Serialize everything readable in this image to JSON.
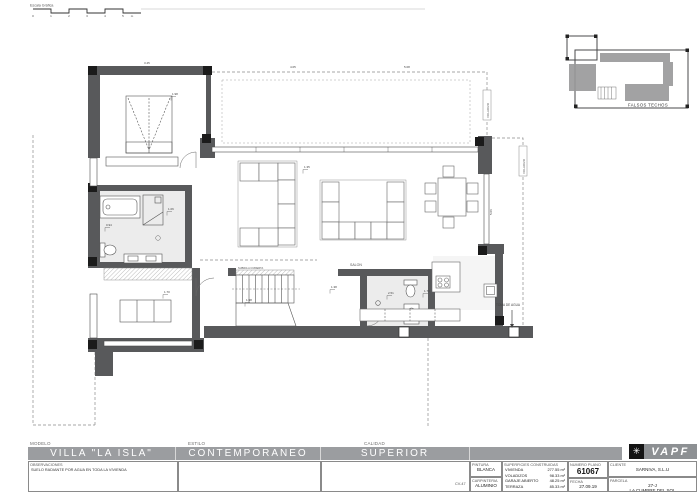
{
  "sheet": {
    "scale_bar": {
      "label": "Escala Gráfica",
      "ticks": [
        "0",
        "1",
        "2",
        "3",
        "4",
        "5"
      ],
      "unit": "m"
    },
    "key_plan": {
      "label": "FALSOS TECHOS"
    },
    "plan": {
      "salon_label": "SALON",
      "stair_note": "SUBIDA A CUBIERTA",
      "overhang_label_a": "VOLADIZO",
      "overhang_label_b": "VOLADIZO",
      "water_point_label": "TOMA DE AGUA",
      "dims": {
        "d_top_1": "3.45",
        "d_top_2": "4.05",
        "d_top_3": "5.08",
        "d_right_v": "5.06",
        "d0": "1.98",
        "d1": "1.06",
        "d2": "0.94",
        "d3": "1.98",
        "d4": "2.51",
        "d5": "1.73",
        "d6": "1.38",
        "d7": "1.35",
        "d8": "1.70"
      }
    },
    "title_block": {
      "modelo_label": "MODELO",
      "modelo": "VILLA \"LA ISLA\"",
      "estilo_label": "ESTILO",
      "estilo": "CONTEMPORANEO",
      "calidad_label": "CALIDAD",
      "calidad": "SUPERIOR",
      "observaciones_label": "OBSERVACIONES",
      "observaciones": "SUELO RADIANTE POR AGUA EN TODA LA VIVIENDA",
      "ref_code": "CV-47",
      "pintura_label": "PINTURA",
      "pintura": "BLANCA",
      "carpinteria_label": "CARPINTERIA",
      "carpinteria": "ALUMINIO",
      "superficies_label": "SUPERFICIES CONSTRUIDAS",
      "superficies": [
        {
          "name": "VIVIENDA",
          "value": "277.55 m²"
        },
        {
          "name": "VOLADIZOS",
          "value": "98.33 m²"
        },
        {
          "name": "GARAJE ABIERTO",
          "value": "48.25 m²"
        },
        {
          "name": "TERRAZA",
          "value": "85.33 m²"
        }
      ],
      "numero_plano_label": "NUMERO PLANO",
      "numero_plano": "61067",
      "fecha_label": "FECHA",
      "fecha": "27.09.19",
      "cliente_label": "CLIENTE",
      "cliente": "SARNIVA, S.L.U",
      "parcela_label": "PARCELA",
      "parcela_line1": "27-J",
      "parcela_line2": "LA CUMBRE DEL SOL",
      "brand": "VAPF"
    },
    "colors": {
      "wall": "#58595b",
      "titlebar": "#9b9da0",
      "brand_bg": "#8d9093"
    }
  }
}
